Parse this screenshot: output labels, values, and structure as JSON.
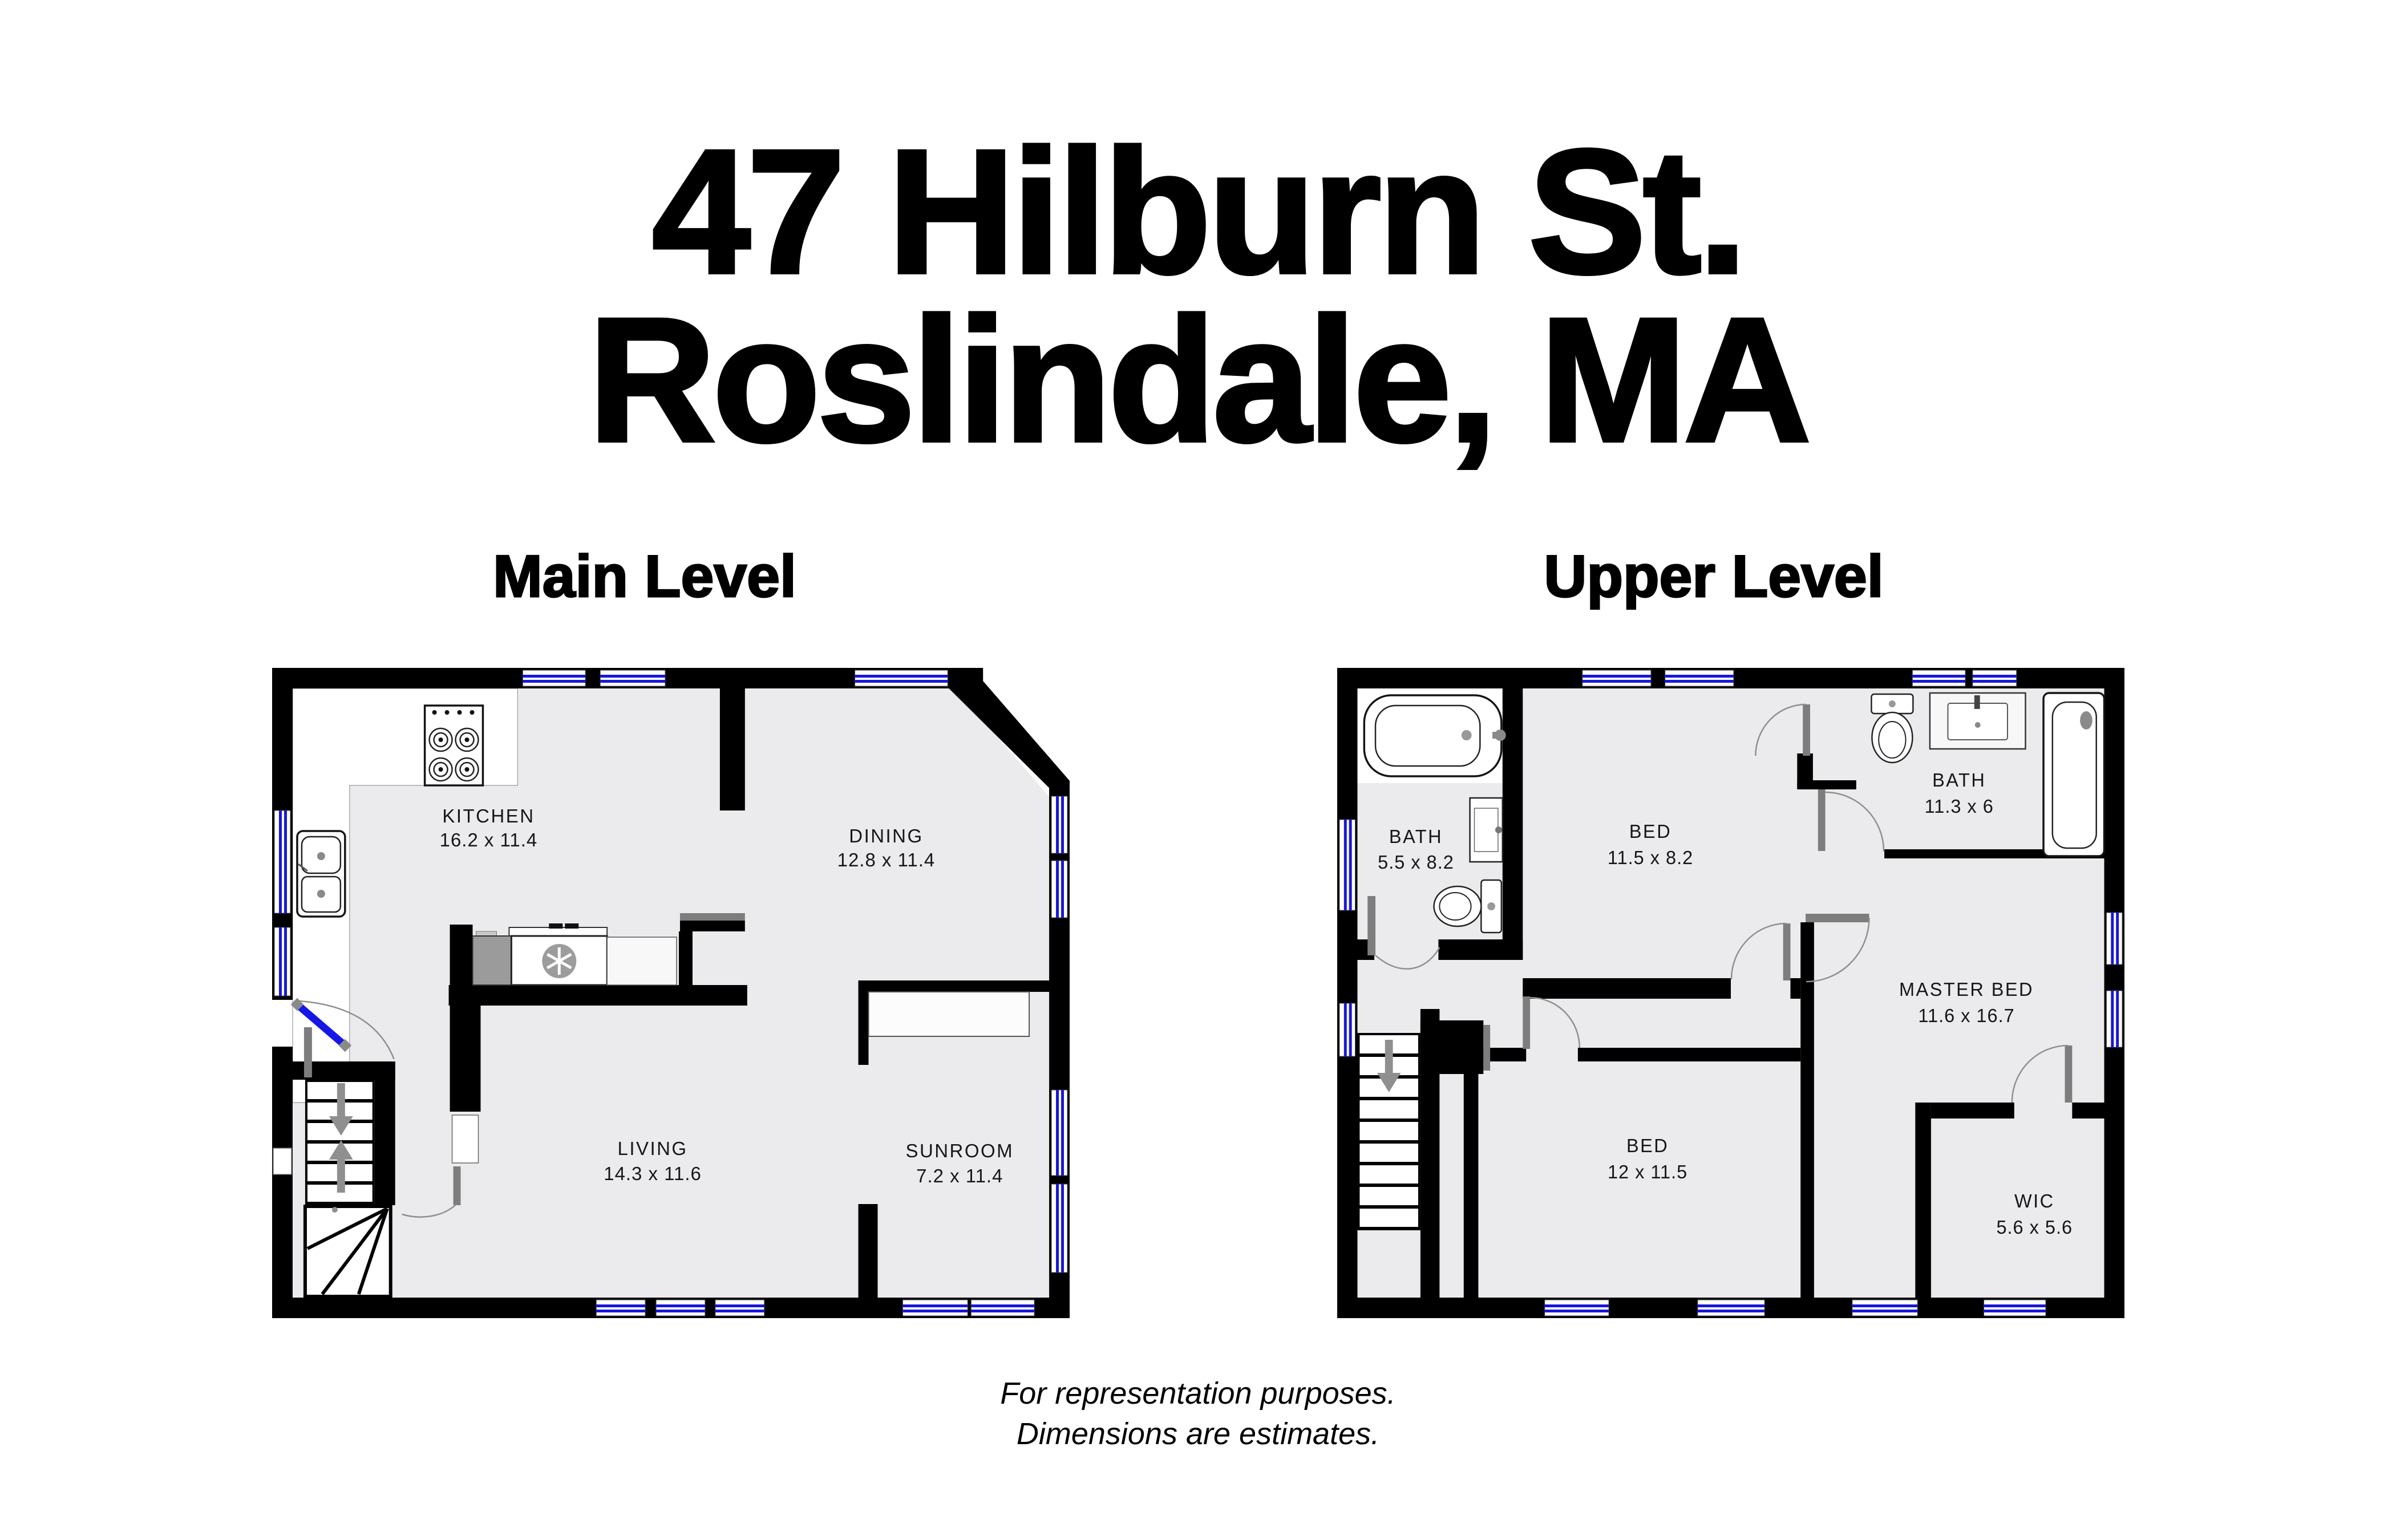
{
  "title": {
    "line1": "47 Hilburn St.",
    "line2": "Roslindale, MA"
  },
  "levels": [
    {
      "label": "Main Level",
      "rooms": [
        {
          "name": "KITCHEN",
          "dims": "16.2 x 11.4"
        },
        {
          "name": "DINING",
          "dims": "12.8 x 11.4"
        },
        {
          "name": "LIVING",
          "dims": "14.3 x 11.6"
        },
        {
          "name": "SUNROOM",
          "dims": "7.2 x 11.4"
        }
      ],
      "fixtures": [
        "stove-icon",
        "kitchen-sink-icon",
        "refrigerator-icon",
        "dishwasher-icon",
        "stairs-up-arrow",
        "stairs-down-arrow",
        "entry-door"
      ]
    },
    {
      "label": "Upper Level",
      "rooms": [
        {
          "name": "BATH",
          "dims": "5.5 x 8.2"
        },
        {
          "name": "BED",
          "dims": "11.5 x 8.2"
        },
        {
          "name": "BATH",
          "dims": "11.3 x 6"
        },
        {
          "name": "MASTER BED",
          "dims": "11.6 x 16.7"
        },
        {
          "name": "BED",
          "dims": "12 x 11.5"
        },
        {
          "name": "WIC",
          "dims": "5.6 x 5.6"
        }
      ],
      "fixtures": [
        "bathtub-icon",
        "toilet-icon",
        "vanity-sink-icon",
        "shower-icon",
        "stairs-down-arrow"
      ]
    }
  ],
  "footer": {
    "line1": "For representation purposes.",
    "line2": "Dimensions are estimates."
  },
  "colors": {
    "wall": "#000000",
    "floor": "#ebebed",
    "window_blue": "#1717dc",
    "door_gray": "#7d7d7d",
    "arrow_gray": "#8f8f8f",
    "fixture_gray": "#9b9b9b",
    "entry_door_blue": "#1616e8"
  }
}
